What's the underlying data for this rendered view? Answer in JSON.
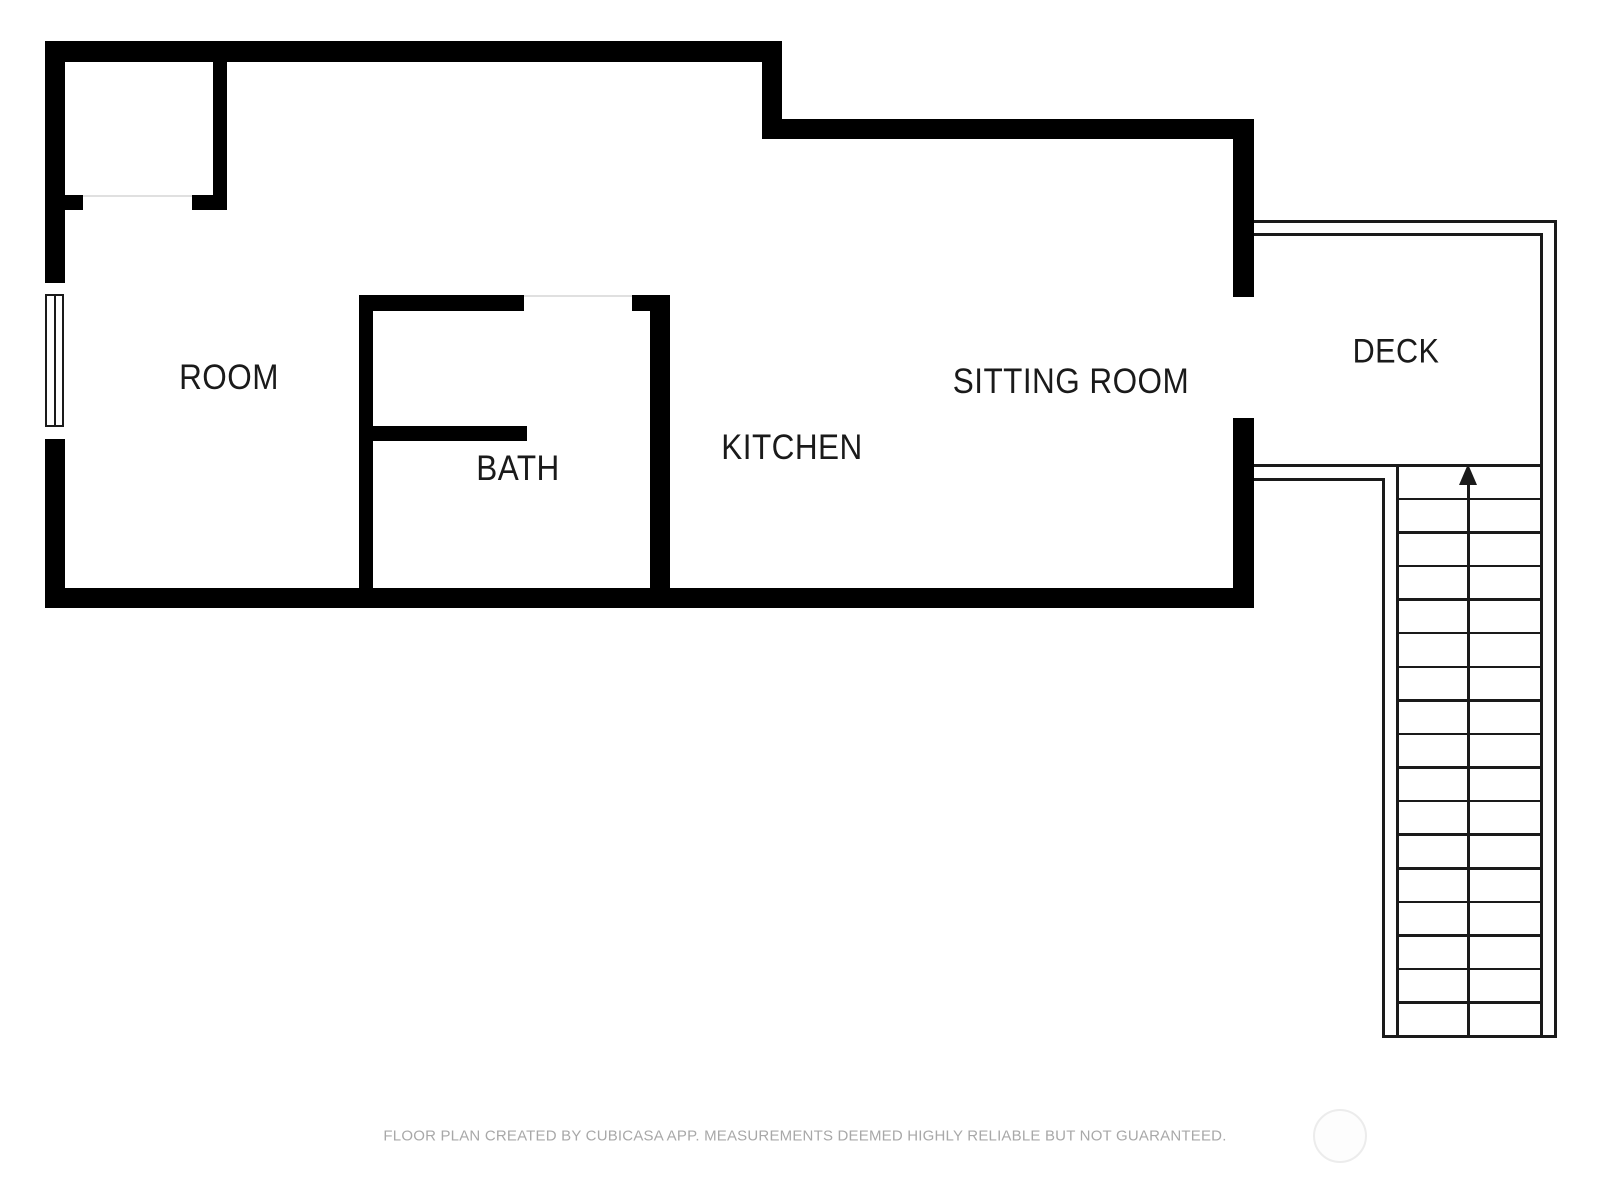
{
  "canvas": {
    "width": 1600,
    "height": 1200,
    "background": "#ffffff"
  },
  "palette": {
    "wall": "#000000",
    "line": "#1a1a1a",
    "threshold": "#e0e0e0",
    "label": "#1a1a1a",
    "footer_text": "#a8a8a8",
    "watermark_ring": "#ececec",
    "watermark_fill": "#fdfdfd"
  },
  "rooms": [
    {
      "name": "room-label-room",
      "label": "ROOM",
      "x": 229,
      "y": 378,
      "font_size": 35
    },
    {
      "name": "room-label-bath",
      "label": "BATH",
      "x": 518,
      "y": 469,
      "font_size": 35
    },
    {
      "name": "room-label-kitchen",
      "label": "KITCHEN",
      "x": 792,
      "y": 448,
      "font_size": 35
    },
    {
      "name": "room-label-sitting-room",
      "label": "SITTING ROOM",
      "x": 1071,
      "y": 382,
      "font_size": 35
    },
    {
      "name": "room-label-deck",
      "label": "DECK",
      "x": 1396,
      "y": 352,
      "font_size": 34
    }
  ],
  "walls": [
    {
      "name": "left-wall-upper",
      "x": 45,
      "y": 41,
      "w": 20,
      "h": 242
    },
    {
      "name": "left-wall-lower",
      "x": 45,
      "y": 439,
      "w": 20,
      "h": 169
    },
    {
      "name": "top-wall-left",
      "x": 45,
      "y": 41,
      "w": 737,
      "h": 21
    },
    {
      "name": "top-step-wall",
      "x": 762,
      "y": 41,
      "w": 20,
      "h": 98
    },
    {
      "name": "top-wall-right",
      "x": 762,
      "y": 119,
      "w": 492,
      "h": 20
    },
    {
      "name": "right-wall-upper",
      "x": 1233,
      "y": 119,
      "w": 21,
      "h": 178
    },
    {
      "name": "right-wall-lower",
      "x": 1233,
      "y": 418,
      "w": 21,
      "h": 190
    },
    {
      "name": "bottom-wall",
      "x": 45,
      "y": 588,
      "w": 1209,
      "h": 20
    },
    {
      "name": "closet-right-wall",
      "x": 213,
      "y": 62,
      "w": 14,
      "h": 148
    },
    {
      "name": "closet-door-stub-left",
      "x": 65,
      "y": 195,
      "w": 18,
      "h": 15
    },
    {
      "name": "closet-door-stub-right",
      "x": 192,
      "y": 195,
      "w": 35,
      "h": 15
    },
    {
      "name": "bath-left-wall",
      "x": 359,
      "y": 295,
      "w": 14,
      "h": 313
    },
    {
      "name": "bath-top-wall",
      "x": 359,
      "y": 295,
      "w": 165,
      "h": 16
    },
    {
      "name": "bath-top-stub",
      "x": 632,
      "y": 295,
      "w": 38,
      "h": 16
    },
    {
      "name": "bath-right-wall",
      "x": 650,
      "y": 295,
      "w": 20,
      "h": 313
    },
    {
      "name": "bath-partition-wall",
      "x": 359,
      "y": 426,
      "w": 168,
      "h": 15
    }
  ],
  "deck_lines": [
    {
      "name": "deck-outer-top-edge",
      "x": 1254,
      "y": 220,
      "w": 303,
      "h": 3
    },
    {
      "name": "deck-outer-right-edge",
      "x": 1554,
      "y": 220,
      "w": 3,
      "h": 818
    },
    {
      "name": "deck-inner-top-edge",
      "x": 1254,
      "y": 233,
      "w": 289,
      "h": 3
    },
    {
      "name": "deck-inner-right-edge",
      "x": 1540,
      "y": 233,
      "w": 3,
      "h": 805
    },
    {
      "name": "deck-bottom-edge",
      "x": 1254,
      "y": 464,
      "w": 289,
      "h": 3
    },
    {
      "name": "landing-top-edge",
      "x": 1254,
      "y": 478,
      "w": 131,
      "h": 3
    },
    {
      "name": "landing-right-edge",
      "x": 1382,
      "y": 478,
      "w": 3,
      "h": 560
    },
    {
      "name": "stairs-left-edge",
      "x": 1396,
      "y": 464,
      "w": 3,
      "h": 574
    },
    {
      "name": "stairs-bottom-edge",
      "x": 1382,
      "y": 1035,
      "w": 175,
      "h": 3
    }
  ],
  "thresholds": [
    {
      "name": "closet-door-threshold",
      "x": 83,
      "y": 195,
      "w": 109,
      "h": 2
    },
    {
      "name": "bath-door-threshold",
      "x": 524,
      "y": 295,
      "w": 108,
      "h": 2
    }
  ],
  "window": {
    "opening": {
      "x": 45,
      "y": 283,
      "w": 20,
      "h": 156
    },
    "frame": {
      "x": 45,
      "y": 294,
      "w": 19,
      "h": 133
    },
    "mullion_x": 54
  },
  "stairs": {
    "x": 1399,
    "w": 141,
    "top": 464,
    "bottom": 1035,
    "steps": 17,
    "arrow_x": 1467,
    "arrow_tip_y": 464,
    "arrow_base_y": 485,
    "arrow_half_width": 9
  },
  "footer": {
    "text": "FLOOR PLAN CREATED BY CUBICASA APP. MEASUREMENTS DEEMED HIGHLY RELIABLE BUT NOT GUARANTEED.",
    "x": 805,
    "y": 1136,
    "font_size": 15
  },
  "watermark": {
    "cx": 1340,
    "cy": 1136,
    "r": 27
  }
}
